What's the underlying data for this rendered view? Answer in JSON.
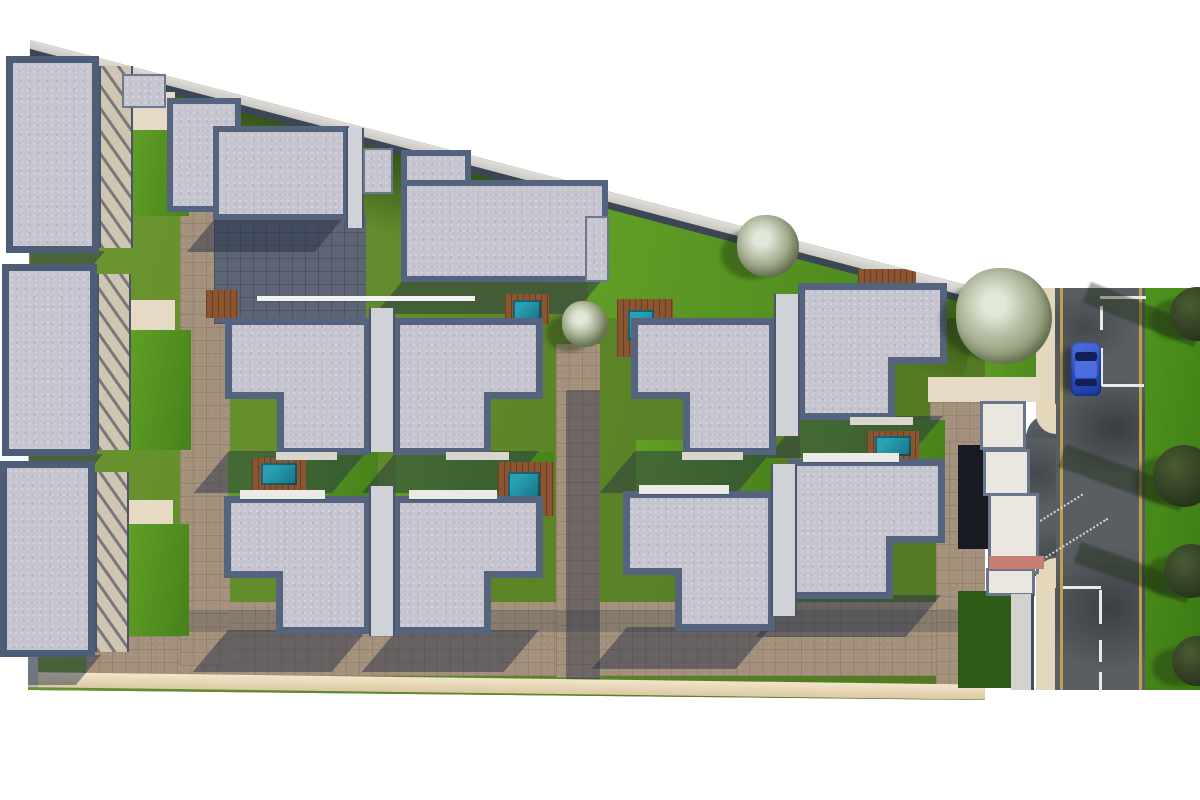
{
  "scene": {
    "type": "architectural-site-plan-render",
    "description": "Top-down 3D render of a gated residential compound: three apartment blocks on the left, ten flat-roof villas with corner notches, plunge pools with wood decks, lawns, paved alleys, a diagonal boundary wall, an entrance gate and a vertical street with a blue car and trees on the right",
    "background": "#ffffff"
  },
  "palette": {
    "roof_fill": "#c6c5cf",
    "roof_border": "#54647f",
    "block_border": "#4d5d78",
    "grass_mid": "#587e27",
    "grass_bright": "#4f8f1d",
    "grass_dark": "#2d5a17",
    "pave_light": "#a4917c",
    "pave_shadow": "#5d6474",
    "wall_light": "#e6e5e1",
    "wall_face": "#3d4654",
    "deck_wood": "#8a5530",
    "pool_water": "#2aa0b4",
    "pool_deep": "#157083",
    "road_asphalt": "#595e63",
    "line_yellow": "#bfa04e",
    "line_white": "#e9e9e7",
    "car_body": "#2a4fc4",
    "car_roof": "#5272e0",
    "car_glass": "#141f55",
    "tree_olive": "#9aa385",
    "tree_dark": "#2f3d25",
    "sidewalk": "#e4d7bb",
    "bottom_band": "#eedfc2",
    "crosswalk_pink": "#c87f73",
    "gate_white": "#eae7e1",
    "dark_court": "#171a20"
  },
  "site": {
    "clip_polygon": [
      [
        30,
        40
      ],
      [
        985,
        290
      ],
      [
        985,
        700
      ],
      [
        28,
        690
      ]
    ],
    "boundary_wall": {
      "x": 24,
      "y": 34,
      "len": 992,
      "angle": 14.8,
      "thick": 13,
      "face": 7
    },
    "bottom_band": {
      "x": 22,
      "y": 672,
      "len": 970,
      "angle": 0.75,
      "thick": 15
    },
    "grass_shadow_band": {
      "x": 26,
      "y": 40,
      "len": 992,
      "h": 95,
      "angle": 14.8
    }
  },
  "ground_patches": [
    {
      "n": "paving-bottom-promenade",
      "cls": "cobble-light",
      "r": [
        86,
        602,
        902,
        74
      ]
    },
    {
      "n": "paving-left-alley",
      "cls": "cobble-light",
      "r": [
        180,
        188,
        50,
        478
      ]
    },
    {
      "n": "court-below-row1",
      "cls": "cobble-dark",
      "r": [
        214,
        214,
        152,
        110
      ]
    },
    {
      "n": "paving-mid-alley",
      "cls": "cobble-light",
      "r": [
        556,
        344,
        44,
        334
      ]
    },
    {
      "n": "paving-right-alley",
      "cls": "cobble-light",
      "r": [
        936,
        400,
        49,
        288
      ]
    },
    {
      "n": "lawn-upper-right",
      "cls": "grass-bright",
      "r": [
        588,
        176,
        397,
        142
      ]
    },
    {
      "n": "entry-court",
      "cls": "cobble-light",
      "r": [
        930,
        382,
        56,
        60
      ]
    },
    {
      "n": "mid-alley-shade",
      "cls": "shade",
      "r": [
        566,
        390,
        34,
        292
      ]
    },
    {
      "n": "promenade-shade",
      "cls": "shade2",
      "r": [
        86,
        610,
        902,
        22
      ]
    },
    {
      "n": "lawn-pocket-1",
      "cls": "grass-bright",
      "r": [
        228,
        452,
        150,
        44
      ]
    },
    {
      "n": "lawn-pocket-2",
      "cls": "grass-bright",
      "r": [
        396,
        452,
        158,
        44
      ]
    },
    {
      "n": "lawn-pocket-3",
      "cls": "grass-bright",
      "r": [
        636,
        440,
        140,
        50
      ]
    },
    {
      "n": "lawn-pocket-4",
      "cls": "grass-bright",
      "r": [
        800,
        420,
        145,
        40
      ]
    }
  ],
  "left_blocks": [
    {
      "n": "block-1",
      "roof": [
        6,
        56,
        93,
        197
      ],
      "annex": [
        99,
        66,
        30,
        182
      ],
      "court": [
        129,
        92,
        46,
        118
      ],
      "lawn": [
        131,
        130,
        58,
        86
      ]
    },
    {
      "n": "block-2",
      "roof": [
        2,
        264,
        95,
        192
      ],
      "annex": [
        97,
        274,
        30,
        176
      ],
      "court": [
        127,
        300,
        48,
        132
      ],
      "lawn": [
        127,
        330,
        64,
        120
      ]
    },
    {
      "n": "block-3",
      "roof": [
        0,
        461,
        95,
        196
      ],
      "annex": [
        95,
        472,
        30,
        180
      ],
      "court": [
        125,
        500,
        48,
        128
      ],
      "lawn": [
        125,
        524,
        64,
        112
      ]
    }
  ],
  "step_buildings": [
    {
      "n": "villa-row1-left",
      "parts": [
        [
          167,
          98,
          74,
          114
        ],
        [
          213,
          126,
          136,
          94
        ]
      ]
    },
    {
      "n": "villa-row1-mid",
      "parts": [
        [
          401,
          150,
          70,
          86
        ],
        [
          401,
          180,
          207,
          102
        ]
      ]
    }
  ],
  "houses": [
    {
      "n": "villa-a",
      "r": [
        225,
        318,
        146,
        137
      ],
      "notch": "bl",
      "sill": true
    },
    {
      "n": "villa-b",
      "r": [
        393,
        318,
        150,
        137
      ],
      "notch": "br",
      "sill": true
    },
    {
      "n": "villa-c",
      "r": [
        631,
        318,
        145,
        137
      ],
      "notch": "bl",
      "sill": true
    },
    {
      "n": "villa-d",
      "r": [
        798,
        283,
        149,
        137
      ],
      "notch": "br",
      "sill": true
    },
    {
      "n": "villa-e",
      "r": [
        224,
        496,
        147,
        138
      ],
      "notch": "bl",
      "canopy": true
    },
    {
      "n": "villa-f",
      "r": [
        393,
        496,
        150,
        138
      ],
      "notch": "br",
      "canopy": true
    },
    {
      "n": "villa-g",
      "r": [
        623,
        491,
        152,
        140
      ],
      "notch": "bl",
      "canopy": true
    },
    {
      "n": "villa-h",
      "r": [
        787,
        459,
        158,
        140
      ],
      "notch": "br",
      "canopy": true
    }
  ],
  "notch_size": [
    52,
    56
  ],
  "connectors": [
    {
      "n": "party-wall-ab",
      "r": [
        369,
        308,
        26,
        144
      ]
    },
    {
      "n": "party-wall-cd",
      "r": [
        774,
        294,
        26,
        142
      ]
    },
    {
      "n": "party-wall-ef",
      "r": [
        369,
        486,
        26,
        150
      ]
    },
    {
      "n": "party-wall-gh",
      "r": [
        771,
        464,
        26,
        152
      ]
    },
    {
      "n": "party-wall-row1",
      "r": [
        346,
        128,
        18,
        100
      ]
    }
  ],
  "minor_roofs": [
    {
      "n": "annex-roof-1",
      "r": [
        363,
        148,
        30,
        46
      ]
    },
    {
      "n": "annex-roof-2",
      "r": [
        122,
        74,
        44,
        34
      ]
    },
    {
      "n": "annex-roof-3",
      "r": [
        585,
        216,
        24,
        66
      ]
    }
  ],
  "white_lines": [
    {
      "n": "pergola-edge-long",
      "r": [
        257,
        296,
        218,
        5
      ]
    },
    {
      "n": "pergola-edge-short",
      "r": [
        424,
        242,
        56,
        4
      ]
    }
  ],
  "pools": [
    {
      "n": "pool-block1",
      "deck": [
        134,
        108,
        38,
        66
      ],
      "water": [
        140,
        116,
        26,
        50
      ]
    },
    {
      "n": "pool-block2",
      "deck": [
        143,
        368,
        48,
        54
      ],
      "water": [
        151,
        377,
        32,
        38
      ]
    },
    {
      "n": "pool-block3",
      "deck": [
        141,
        554,
        48,
        56
      ],
      "water": [
        149,
        562,
        32,
        40
      ]
    },
    {
      "n": "pool-court-1",
      "deck": [
        252,
        458,
        54,
        32
      ],
      "water": [
        261,
        463,
        36,
        22
      ]
    },
    {
      "n": "pool-court-2",
      "deck": [
        498,
        462,
        56,
        54
      ],
      "water": [
        508,
        472,
        32,
        26
      ]
    },
    {
      "n": "pool-court-3",
      "deck": [
        867,
        431,
        52,
        28
      ],
      "water": [
        875,
        436,
        36,
        20
      ]
    },
    {
      "n": "pool-court-4",
      "deck": [
        617,
        299,
        56,
        58
      ],
      "water": [
        628,
        310,
        26,
        30
      ]
    },
    {
      "n": "pool-court-5",
      "deck": [
        505,
        294,
        44,
        30
      ],
      "water": [
        513,
        300,
        28,
        20
      ]
    }
  ],
  "decks_only": [
    {
      "n": "deck-1",
      "r": [
        206,
        290,
        32,
        28
      ]
    },
    {
      "n": "deck-2",
      "r": [
        858,
        269,
        58,
        18
      ]
    }
  ],
  "trees_olive": [
    {
      "n": "olive-tree-lawn",
      "cx": 768,
      "cy": 246,
      "r": 31
    },
    {
      "n": "olive-tree-gate",
      "cx": 1004,
      "cy": 316,
      "r": 48
    },
    {
      "n": "olive-tree-alley",
      "cx": 585,
      "cy": 324,
      "r": 23
    }
  ],
  "trees_dark": [
    {
      "n": "street-tree-1",
      "cx": 1197,
      "cy": 314,
      "r": 27
    },
    {
      "n": "street-tree-2",
      "cx": 1184,
      "cy": 476,
      "r": 31
    },
    {
      "n": "street-tree-3",
      "cx": 1191,
      "cy": 571,
      "r": 27
    },
    {
      "n": "street-tree-4",
      "cx": 1197,
      "cy": 661,
      "r": 25
    }
  ],
  "tree_streaks": [
    {
      "n": "tree-shadow-streak-1",
      "r": [
        1078,
        326,
        120,
        22
      ],
      "rot": 22
    },
    {
      "n": "tree-shadow-streak-2",
      "r": [
        1054,
        488,
        130,
        24
      ],
      "rot": 20
    },
    {
      "n": "tree-shadow-streak-3",
      "r": [
        1070,
        582,
        120,
        22
      ],
      "rot": 20
    }
  ],
  "road": {
    "zone": [
      985,
      288,
      215,
      402
    ],
    "asphalt": [
      1055,
      288,
      90,
      402
    ],
    "verge": [
      1145,
      288,
      55,
      402
    ],
    "left_lawn": [
      985,
      288,
      70,
      112
    ],
    "sidewalk": [
      1036,
      288,
      20,
      402
    ],
    "yellow_lines": [
      [
        1060,
        288,
        3,
        402
      ],
      [
        1139,
        288,
        3,
        402
      ]
    ],
    "white_marks": [
      [
        1100,
        296,
        46,
        3
      ],
      [
        1100,
        306,
        3,
        24
      ],
      [
        1100,
        348,
        3,
        38
      ],
      [
        1102,
        384,
        42,
        3
      ],
      [
        1063,
        586,
        38,
        3
      ],
      [
        1099,
        590,
        3,
        34
      ],
      [
        1099,
        640,
        3,
        22
      ],
      [
        1099,
        672,
        3,
        18
      ]
    ],
    "driveway": [
      1006,
      434,
      50,
      126
    ],
    "drive_flare_top": [
      1026,
      414,
      30,
      24
    ],
    "drive_flare_bot": [
      1026,
      556,
      30,
      26
    ],
    "curb_top": [
      1036,
      404,
      20,
      30
    ],
    "curb_bot": [
      1036,
      558,
      20,
      30
    ],
    "dotted_guides": [
      {
        "r": [
          1018,
          512,
          70
        ],
        "rot": -32
      },
      {
        "r": [
          1030,
          540,
          84
        ],
        "rot": -32
      }
    ]
  },
  "car": {
    "n": "blue-car",
    "body": [
      1071,
      342,
      30,
      54
    ],
    "windshield": [
      1075,
      352,
      22,
      9
    ],
    "rear_window": [
      1075,
      379,
      22,
      7
    ],
    "roof": [
      1075,
      361,
      22,
      17
    ]
  },
  "gate": {
    "walkway": [
      928,
      377,
      112,
      25
    ],
    "dark_court": [
      958,
      445,
      32,
      104
    ],
    "boxes": [
      [
        980,
        401,
        46,
        49
      ],
      [
        983,
        449,
        47,
        47
      ],
      [
        988,
        493,
        51,
        81
      ],
      [
        986,
        568,
        49,
        28
      ]
    ],
    "crosswalk": [
      989,
      556,
      55,
      13
    ],
    "wall": [
      1011,
      594,
      23,
      96
    ],
    "lawn_pocket": [
      958,
      591,
      53,
      97
    ]
  },
  "base_wedge": [
    8,
    655,
    30,
    32
  ]
}
